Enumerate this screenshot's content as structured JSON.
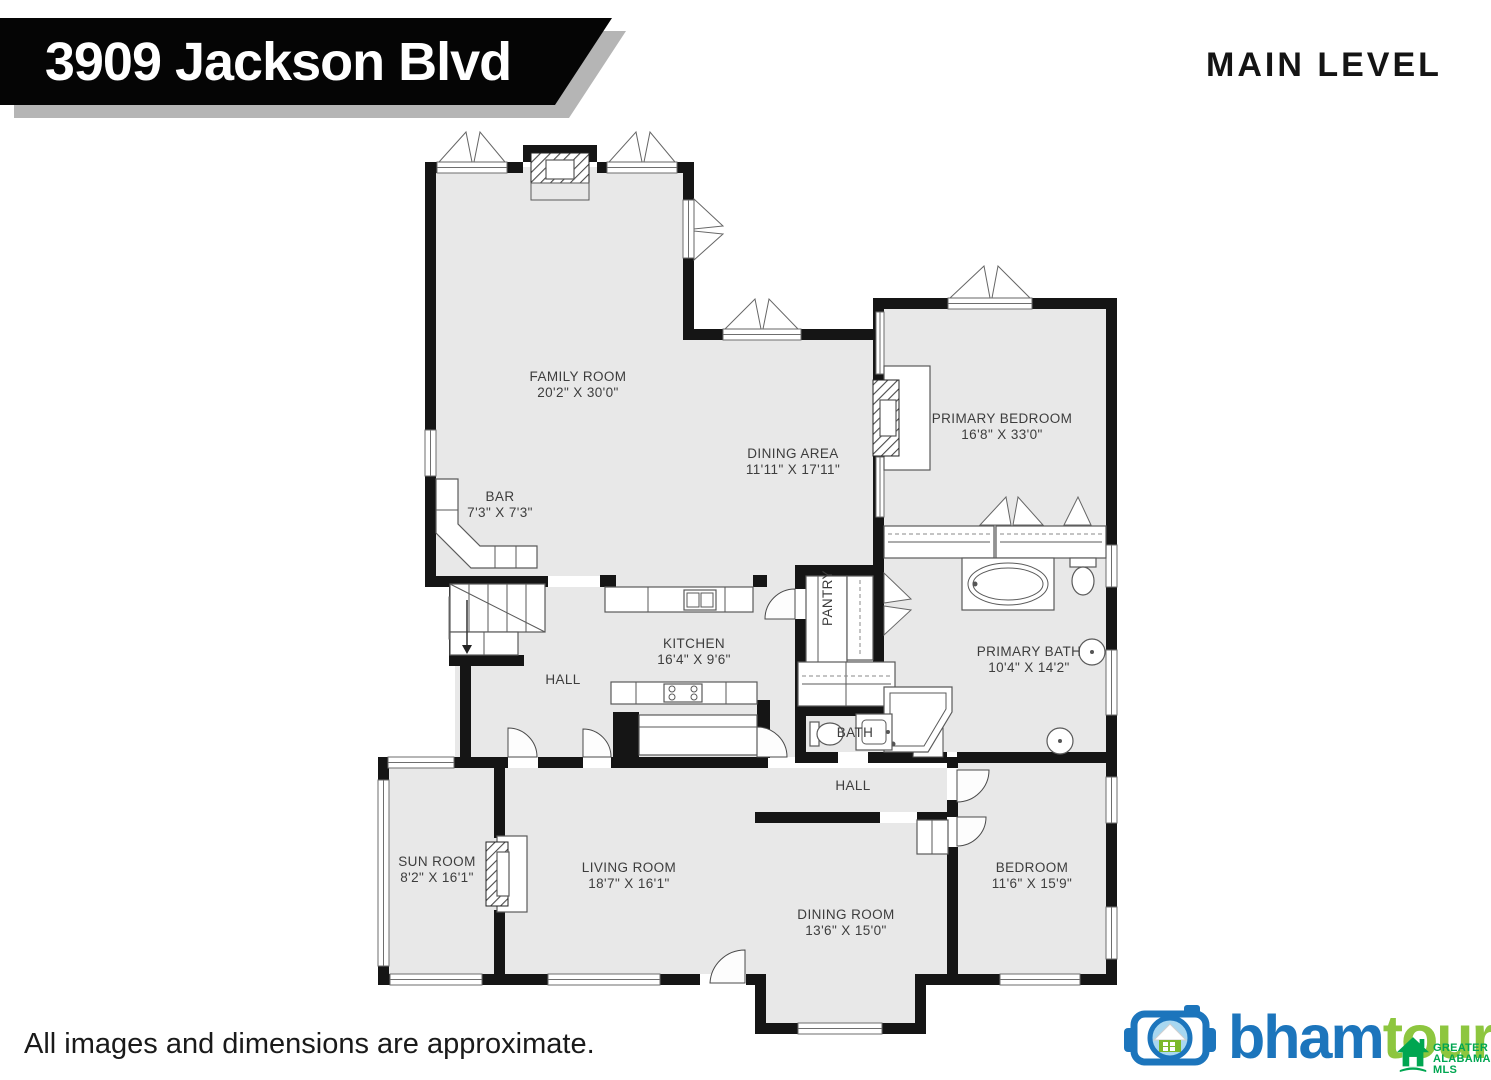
{
  "header": {
    "address": "3909 Jackson Blvd",
    "level": "MAIN LEVEL"
  },
  "footer": {
    "disclaimer": "All images and dimensions are approximate.",
    "logo": {
      "part1": "bham",
      "part2": "tours"
    },
    "mls": {
      "line1": "GREATER",
      "line2": "ALABAMA",
      "line3": "MLS"
    }
  },
  "colors": {
    "wall": "#151515",
    "room_fill": "#e8e8e8",
    "banner_bg": "#050505",
    "banner_shadow": "#b5b5b5",
    "logo_blue": "#1c75bc",
    "logo_green": "#8dc63f",
    "mls_green": "#00a651",
    "lens_blue": "#a8d7f0"
  },
  "icons": [
    "camera-house-icon",
    "mls-house-icon",
    "window-marker-icon",
    "door-swing-icon",
    "stairs-icon",
    "fireplace-icon",
    "bathtub-icon",
    "toilet-icon",
    "sink-icon",
    "stove-icon",
    "kitchen-sink-icon",
    "closet-rod-icon"
  ],
  "rooms": [
    {
      "id": "family-room",
      "name": "FAMILY ROOM",
      "dims": "20'2\" X 30'0\""
    },
    {
      "id": "dining-area",
      "name": "DINING AREA",
      "dims": "11'11\" X 17'11\""
    },
    {
      "id": "bar",
      "name": "BAR",
      "dims": "7'3\" X 7'3\""
    },
    {
      "id": "primary-bedroom",
      "name": "PRIMARY BEDROOM",
      "dims": "16'8\" X 33'0\""
    },
    {
      "id": "kitchen",
      "name": "KITCHEN",
      "dims": "16'4\" X 9'6\""
    },
    {
      "id": "pantry",
      "name": "PANTRY",
      "dims": ""
    },
    {
      "id": "hall-upper",
      "name": "HALL",
      "dims": ""
    },
    {
      "id": "primary-bath",
      "name": "PRIMARY BATH",
      "dims": "10'4\" X 14'2\""
    },
    {
      "id": "bath",
      "name": "BATH",
      "dims": ""
    },
    {
      "id": "hall-lower",
      "name": "HALL",
      "dims": ""
    },
    {
      "id": "sun-room",
      "name": "SUN ROOM",
      "dims": "8'2\" X 16'1\""
    },
    {
      "id": "living-room",
      "name": "LIVING ROOM",
      "dims": "18'7\" X 16'1\""
    },
    {
      "id": "dining-room",
      "name": "DINING ROOM",
      "dims": "13'6\" X 15'0\""
    },
    {
      "id": "bedroom",
      "name": "BEDROOM",
      "dims": "11'6\" X 15'9\""
    }
  ]
}
